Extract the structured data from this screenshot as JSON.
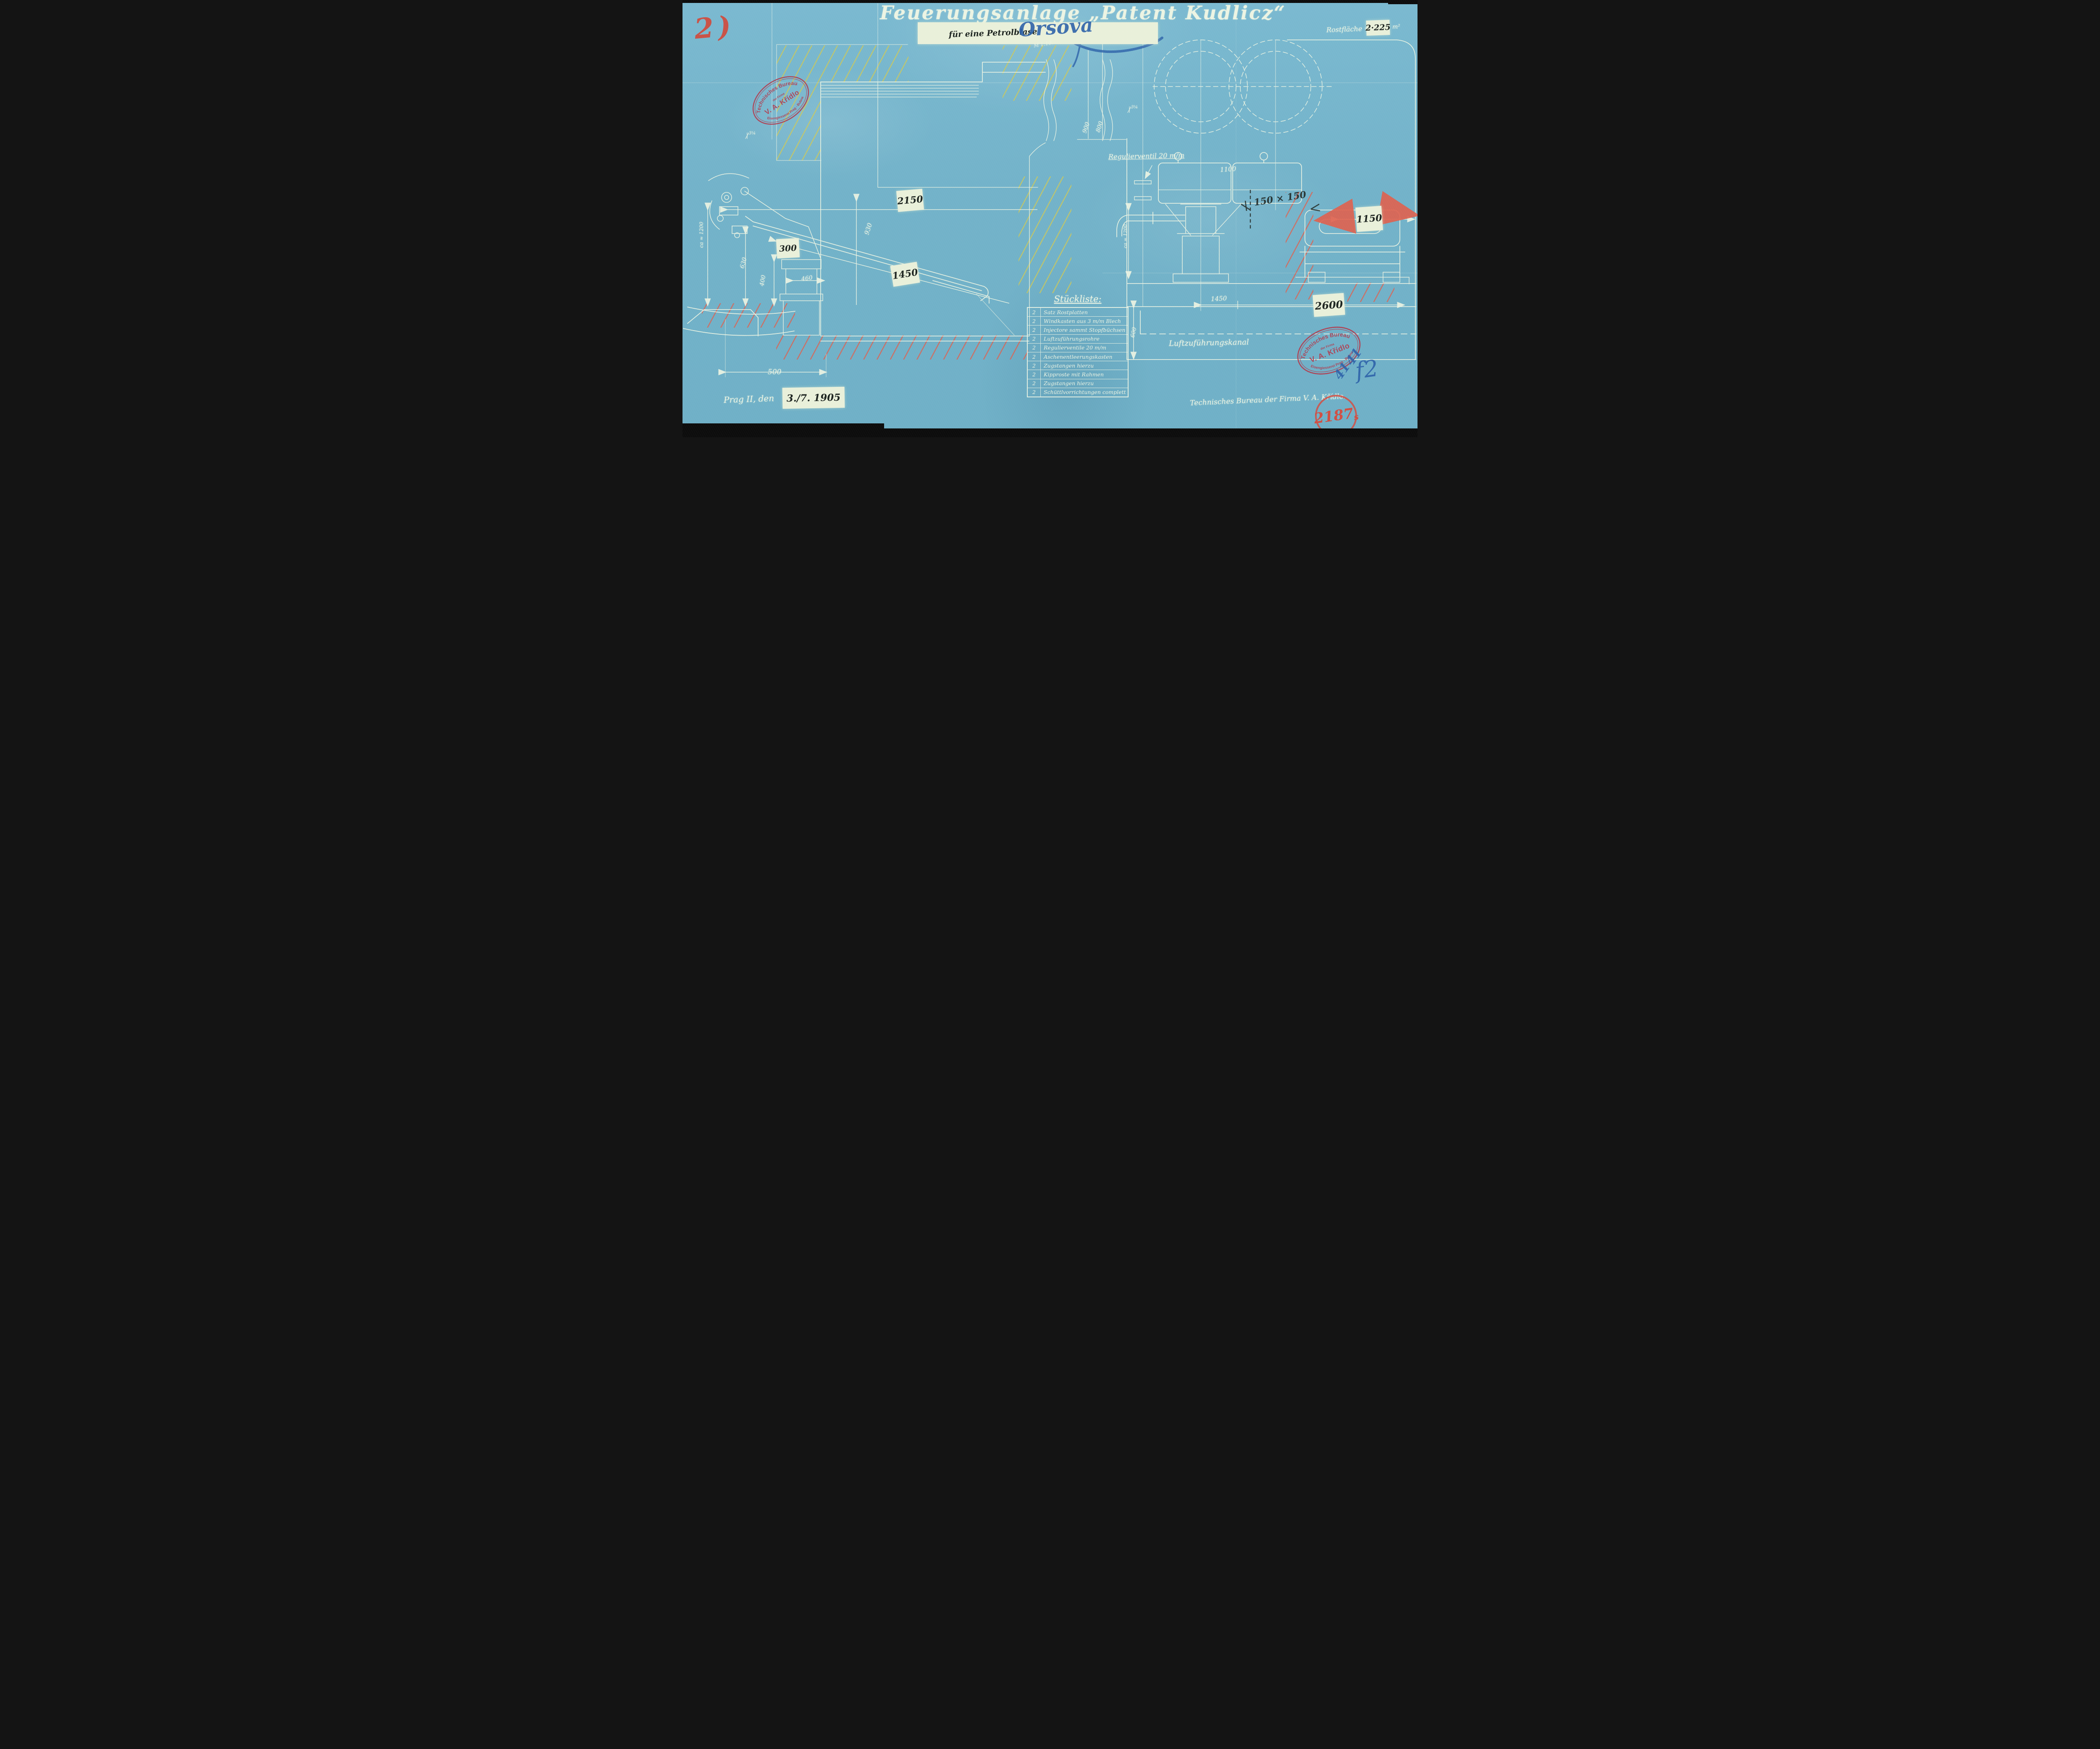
{
  "page": {
    "sheet_mark": "2)",
    "title": "Feuerungsanlage „Patent Kudlicz“",
    "subtitle": "für eine Petrolblase",
    "subtitle_annotation": "Orsova",
    "scale_note": "M 1:10.",
    "grate_area": {
      "label": "Rostfläche =",
      "value": "2·225",
      "unit": "m²"
    },
    "place_date": {
      "place": "Prag II, den",
      "date": "3./7. 1905"
    },
    "bureau_signature": "Technisches Bureau der Firma V. A. Křídlo.",
    "drawing_number": {
      "value": "2187",
      "suffix": "s"
    },
    "blue_marks": {
      "mark1": "41",
      "mark2": "41",
      "mark3": "f2"
    }
  },
  "stamp": {
    "arc_top": "Technisches Bureau",
    "line_small": "der Firma",
    "name": "V. A. Křídlo",
    "arc_bottom": "Eisengiesserei Prag - Bubna"
  },
  "parts_list": {
    "title": "Stückliste:",
    "rows": [
      {
        "qty": "2",
        "desc": "Satz Rostplatten"
      },
      {
        "qty": "2",
        "desc": "Windkasten aus 3 m/m Blech"
      },
      {
        "qty": "2",
        "desc": "Injectore sammt Stopfbüchsen"
      },
      {
        "qty": "2",
        "desc": "Luftzuführungsrohre"
      },
      {
        "qty": "2",
        "desc": "Regulierventile 20 m/m"
      },
      {
        "qty": "2",
        "desc": "Aschenentleerungskasten"
      },
      {
        "qty": "2",
        "desc": "Zugstangen hierzu"
      },
      {
        "qty": "2",
        "desc": "Kipproste mit Rahmen"
      },
      {
        "qty": "2",
        "desc": "Zugstangen hierzu"
      },
      {
        "qty": "2",
        "desc": "Schüttlvorrichtungen complett"
      }
    ]
  },
  "annotations": {
    "regulator_valve": "Regulierventil 20 m/m",
    "air_duct": "Luftzuführungskanal"
  },
  "dimensions": {
    "left_view": {
      "width_top": "2150",
      "depth": "300",
      "grate_length_dim": "1450",
      "grate_width": "930",
      "left_height": "630",
      "door_height": "400",
      "pedestal": "460",
      "base_width": "500",
      "approx_height": "ca ≈ 1200",
      "small_mark": "3¼"
    },
    "right_view": {
      "boiler_gap": "900",
      "boiler_gap2": "800",
      "box_width": "1100",
      "beam": "150 × 150",
      "right_span": "1150",
      "total_width": "2600",
      "pedestal_width": "1450",
      "approx_height": "ca = 1200",
      "duct_height": "600",
      "small_mark": "3¼"
    }
  },
  "colors": {
    "paper_blue": "#72b2c9",
    "line_white": "#ecf4e3",
    "patch_white": "#e9f0da",
    "ink_black": "#1d2420",
    "stamp_red": "#b23b4e",
    "crayon_red": "#d04a3c",
    "crayon_blue": "#2d62a9",
    "hatch_yellow": "#d6ca4d",
    "hatch_red": "#e0604d"
  }
}
